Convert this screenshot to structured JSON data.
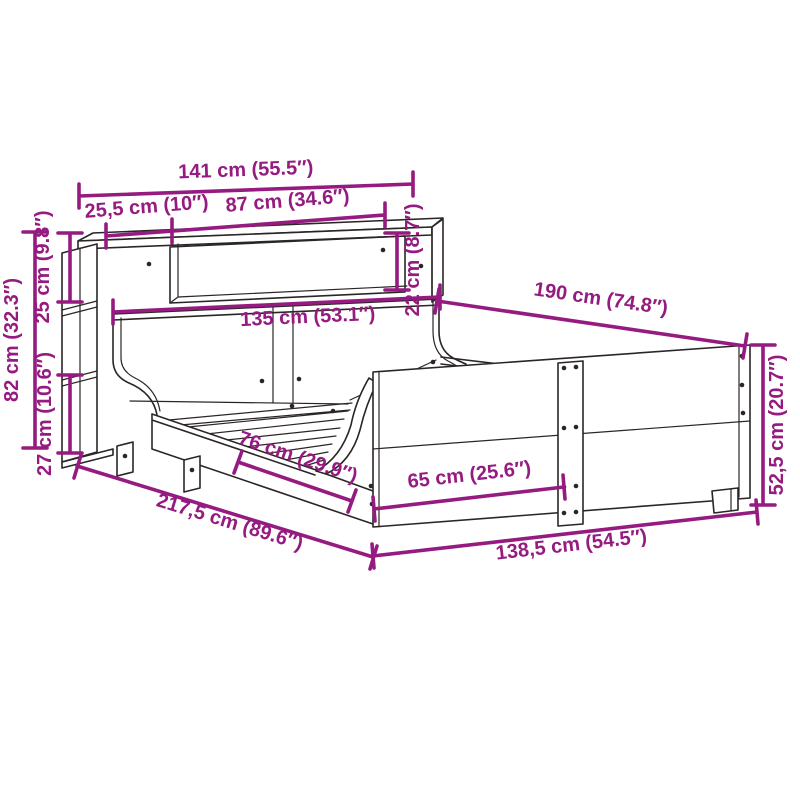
{
  "figure": {
    "type": "product-dimension-diagram",
    "subject": "bed frame with bookcase headboard",
    "background_color": "#ffffff",
    "outline_color": "#2b2626",
    "dimension_color": "#951b81",
    "unit_primary": "cm",
    "unit_secondary": "inches"
  },
  "dims": {
    "total_width": {
      "label": "141 cm (55.5″)"
    },
    "shelf_left_section": {
      "label": "25,5 cm (10″)"
    },
    "shelf_opening_width": {
      "label": "87 cm (34.6″)"
    },
    "shelf_opening_height": {
      "label": "22 cm (8.7″)"
    },
    "inner_length": {
      "label": "190 cm (74.8″)"
    },
    "headboard_width": {
      "label": "135 cm (53.1″)"
    },
    "top_section_height": {
      "label": "25 cm (9.8″)"
    },
    "headboard_height": {
      "label": "82 cm (32.3″)"
    },
    "bottom_section_height": {
      "label": "27 cm (10.6″)"
    },
    "leg_clearance": {
      "label": "76 cm (29.9″)"
    },
    "foot_clearance": {
      "label": "65 cm (25.6″)"
    },
    "footboard_height": {
      "label": "52,5 cm (20.7″)"
    },
    "total_length": {
      "label": "217,5 cm (89.6″)"
    },
    "total_foot_width": {
      "label": "138,5 cm (54.5″)"
    }
  }
}
